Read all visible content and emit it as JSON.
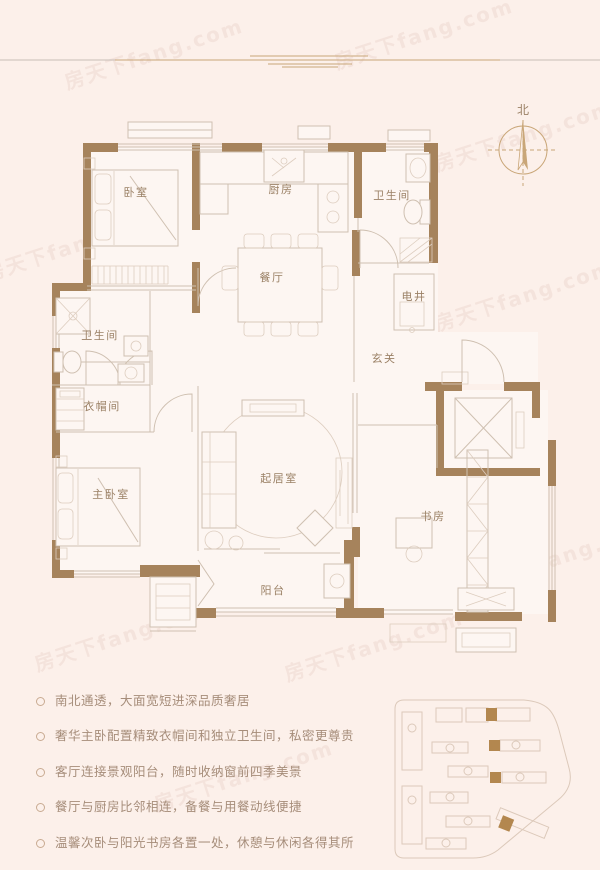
{
  "watermark": "房天下fang.com",
  "compass": {
    "north_label": "北"
  },
  "rooms": {
    "bedroom": {
      "label": "卧室"
    },
    "kitchen": {
      "label": "厨房"
    },
    "bath_top": {
      "label": "卫生间"
    },
    "dining": {
      "label": "餐厅"
    },
    "shaft": {
      "label": "电井"
    },
    "foyer": {
      "label": "玄关"
    },
    "bath_left": {
      "label": "卫生间"
    },
    "cloakroom": {
      "label": "衣帽间"
    },
    "master": {
      "label": "主卧室"
    },
    "living": {
      "label": "起居室"
    },
    "study": {
      "label": "书房"
    },
    "balcony": {
      "label": "阳台"
    }
  },
  "features": [
    "南北通透，大面宽短进深品质奢居",
    "奢华主卧配置精致衣帽间和独立卫生间，私密更尊贵",
    "客厅连接景观阳台，随时收纳窗前四季美景",
    "餐厅与厨房比邻相连，备餐与用餐动线便捷",
    "温馨次卧与阳光书房各置一处，休憩与休闲各得其所"
  ],
  "colors": {
    "background": "#fcf0ea",
    "wall": "#a6835c",
    "line": "#cfc0b1",
    "accent_gold": "#c9a678",
    "label_text": "#9b8166",
    "feature_text": "#a68d7a",
    "site_highlight": "#b3874f"
  }
}
